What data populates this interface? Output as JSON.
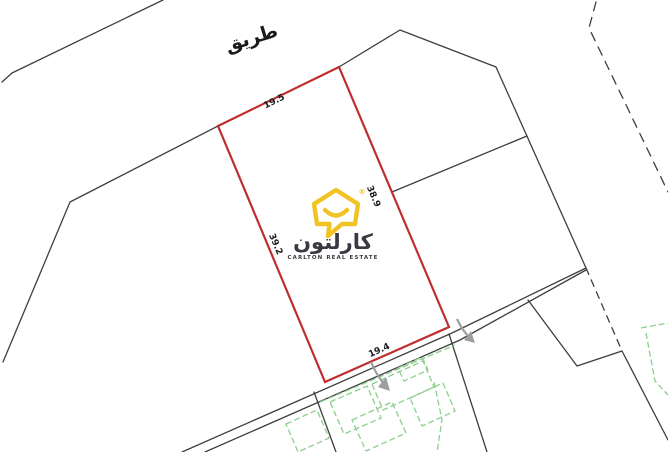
{
  "canvas": {
    "width": 668,
    "height": 452,
    "background": "#ffffff"
  },
  "map": {
    "road_label": "طريق",
    "plot": {
      "outline_color": "#bf2e2e",
      "dimensions": {
        "top": "19.5",
        "right": "38.9",
        "left": "39.2",
        "bottom": "19.4"
      }
    },
    "colors": {
      "boundary": "#3e3e3e",
      "buildings": "#8ccf8c",
      "arrow": "#9e9e9e",
      "label": "#1b1b1b"
    }
  },
  "logo": {
    "brand_ar": "كارلتون",
    "brand_en": "CARLTON REAL ESTATE",
    "registered_mark": "®",
    "icon_color": "#f2c21e",
    "text_color": "#33333e"
  }
}
